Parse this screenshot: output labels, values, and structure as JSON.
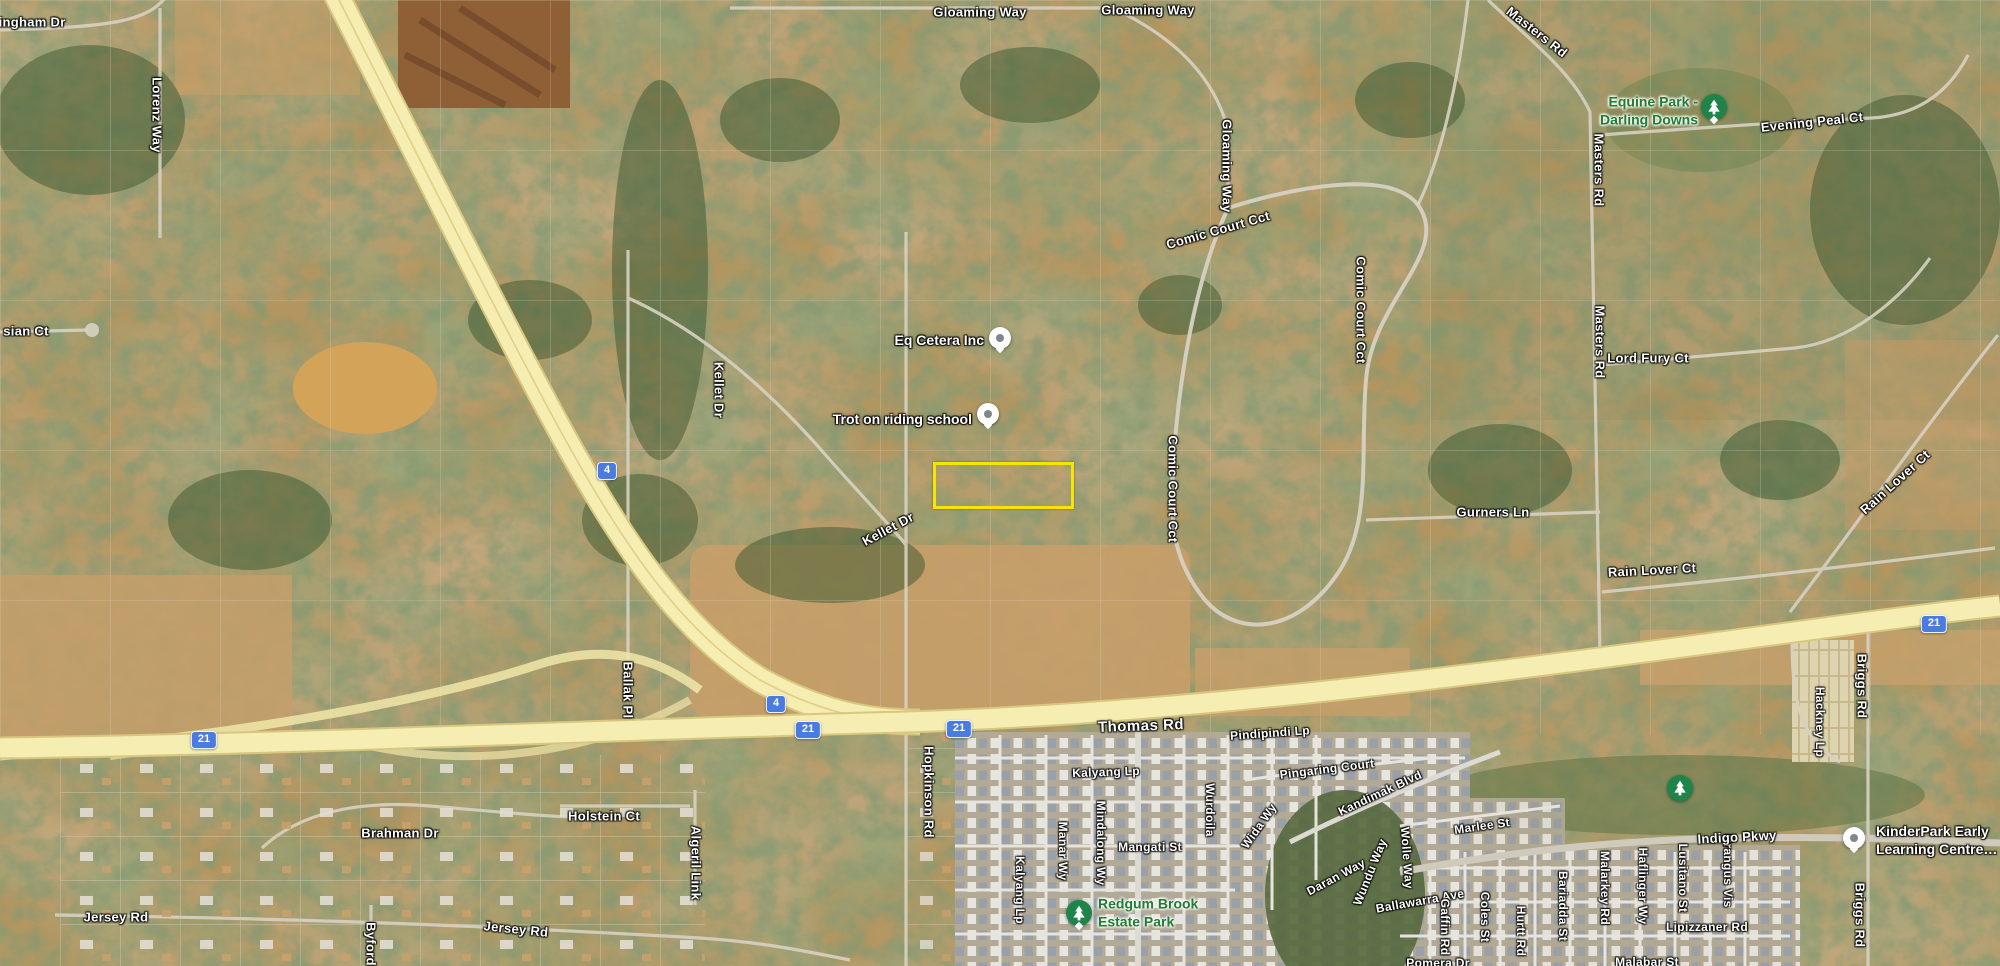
{
  "map": {
    "colors": {
      "highlight": "#f7e400",
      "freeway_yellow": "#f5edb2",
      "route_shield_blue": "#4a7ce0",
      "park_pin_green": "#1e8449",
      "park_text_green": "#217b31"
    },
    "highlight_parcel": {
      "x": 933,
      "y": 462,
      "w": 135,
      "h": 41
    },
    "road_labels": [
      {
        "text": "ningham Dr",
        "x": 28,
        "y": 22
      },
      {
        "text": "Lorenz Way",
        "x": 157,
        "y": 115,
        "rot": 90
      },
      {
        "text": "Gloaming Way",
        "x": 980,
        "y": 12
      },
      {
        "text": "Gloaming Way",
        "x": 1148,
        "y": 10
      },
      {
        "text": "Gloaming Way",
        "x": 1227,
        "y": 166,
        "rot": 90
      },
      {
        "text": "Masters Rd",
        "x": 1537,
        "y": 32,
        "rot": 38
      },
      {
        "text": "Evening Peal Ct",
        "x": 1812,
        "y": 122,
        "rot": -6
      },
      {
        "text": "Masters Rd",
        "x": 1599,
        "y": 170,
        "rot": 90
      },
      {
        "text": "Comic Court Cct",
        "x": 1218,
        "y": 230,
        "rot": -16
      },
      {
        "text": "Comic Court Cct",
        "x": 1361,
        "y": 310,
        "rot": 90
      },
      {
        "text": "Comic Court Cct",
        "x": 1173,
        "y": 489,
        "rot": 90
      },
      {
        "text": "Kellet Dr",
        "x": 719,
        "y": 390,
        "rot": 90
      },
      {
        "text": "Kellet Dr",
        "x": 888,
        "y": 529,
        "rot": -28
      },
      {
        "text": "Gurners Ln",
        "x": 1493,
        "y": 512
      },
      {
        "text": "Masters Rd",
        "x": 1600,
        "y": 342,
        "rot": 90
      },
      {
        "text": "Lord Fury Ct",
        "x": 1648,
        "y": 358
      },
      {
        "text": "Rain Lover Ct",
        "x": 1895,
        "y": 482,
        "rot": -42
      },
      {
        "text": "Rain Lover Ct",
        "x": 1652,
        "y": 570,
        "rot": -3
      },
      {
        "text": "Thomas Rd",
        "x": 1141,
        "y": 726,
        "rot": -2,
        "big": true
      },
      {
        "text": "Hopkinson Rd",
        "x": 929,
        "y": 792,
        "rot": 90
      },
      {
        "text": "Ballak Pl",
        "x": 628,
        "y": 690,
        "rot": 90
      },
      {
        "text": "Briggs Rd",
        "x": 1862,
        "y": 686,
        "rot": 90
      },
      {
        "text": "Hackney Lp",
        "x": 1820,
        "y": 722,
        "rot": 90,
        "small": true
      },
      {
        "text": "Pindipindi Lp",
        "x": 1270,
        "y": 733,
        "rot": -4,
        "small": true
      },
      {
        "text": "Pingaring Court",
        "x": 1327,
        "y": 769,
        "rot": -7,
        "small": true
      },
      {
        "text": "Kalyang Lp",
        "x": 1106,
        "y": 772,
        "rot": -2,
        "small": true
      },
      {
        "text": "Kalyang Lp",
        "x": 1020,
        "y": 890,
        "rot": 90,
        "small": true
      },
      {
        "text": "Manar Wy",
        "x": 1063,
        "y": 851,
        "rot": 90,
        "small": true
      },
      {
        "text": "Mindalong Wy",
        "x": 1101,
        "y": 843,
        "rot": 90,
        "small": true
      },
      {
        "text": "Mangati St",
        "x": 1150,
        "y": 847,
        "small": true
      },
      {
        "text": "Wurdoila",
        "x": 1210,
        "y": 810,
        "rot": 90,
        "small": true
      },
      {
        "text": "Wida Wy",
        "x": 1259,
        "y": 826,
        "rot": -55,
        "small": true
      },
      {
        "text": "Kandimak Blvd",
        "x": 1380,
        "y": 793,
        "rot": -25,
        "small": true
      },
      {
        "text": "Daran Way",
        "x": 1336,
        "y": 877,
        "rot": -28,
        "small": true
      },
      {
        "text": "Wundu Way",
        "x": 1370,
        "y": 872,
        "rot": -68,
        "small": true
      },
      {
        "text": "Ballawarra Ave",
        "x": 1420,
        "y": 901,
        "rot": -10,
        "small": true
      },
      {
        "text": "Marlee St",
        "x": 1482,
        "y": 826,
        "rot": -8,
        "small": true
      },
      {
        "text": "Wolle Way",
        "x": 1407,
        "y": 858,
        "rot": 86,
        "small": true
      },
      {
        "text": "Gaffin Rd",
        "x": 1445,
        "y": 927,
        "rot": 90,
        "small": true
      },
      {
        "text": "Coles St",
        "x": 1485,
        "y": 917,
        "rot": 90,
        "small": true
      },
      {
        "text": "Hurtt Rd",
        "x": 1521,
        "y": 931,
        "rot": 90,
        "small": true
      },
      {
        "text": "Bariadda St",
        "x": 1563,
        "y": 906,
        "rot": 90,
        "small": true
      },
      {
        "text": "Malarkey Rd",
        "x": 1605,
        "y": 888,
        "rot": 90,
        "small": true
      },
      {
        "text": "Haflinger Wy",
        "x": 1643,
        "y": 886,
        "rot": 90,
        "small": true
      },
      {
        "text": "Lusitano St",
        "x": 1683,
        "y": 878,
        "rot": 90,
        "small": true
      },
      {
        "text": "Brangus Vis",
        "x": 1728,
        "y": 871,
        "rot": 90,
        "small": true
      },
      {
        "text": "Lipizzaner Rd",
        "x": 1707,
        "y": 927,
        "small": true
      },
      {
        "text": "Malabar St",
        "x": 1647,
        "y": 962,
        "small": true
      },
      {
        "text": "Pomera Dr",
        "x": 1438,
        "y": 963,
        "small": true
      },
      {
        "text": "Indigo Pkwy",
        "x": 1737,
        "y": 837,
        "rot": -3
      },
      {
        "text": "Briggs Rd",
        "x": 1860,
        "y": 915,
        "rot": 90
      },
      {
        "text": "sian Ct",
        "x": 26,
        "y": 331
      },
      {
        "text": "Jersey Rd",
        "x": 116,
        "y": 917
      },
      {
        "text": "Jersey Rd",
        "x": 516,
        "y": 929,
        "rot": 6
      },
      {
        "text": "Byford",
        "x": 371,
        "y": 944,
        "rot": 90
      },
      {
        "text": "Brahman Dr",
        "x": 400,
        "y": 833
      },
      {
        "text": "Holstein Ct",
        "x": 604,
        "y": 816
      },
      {
        "text": "Algeril Link",
        "x": 696,
        "y": 863,
        "rot": 90
      }
    ],
    "route_shields": [
      {
        "number": "4",
        "x": 607,
        "y": 471
      },
      {
        "number": "4",
        "x": 776,
        "y": 704
      },
      {
        "number": "21",
        "x": 204,
        "y": 740
      },
      {
        "number": "21",
        "x": 808,
        "y": 730
      },
      {
        "number": "21",
        "x": 959,
        "y": 729
      },
      {
        "number": "21",
        "x": 1934,
        "y": 624
      }
    ],
    "pois": [
      {
        "name": "Eq Cetera Inc",
        "lines": [
          "Eq Cetera Inc"
        ],
        "pin_x": 1000,
        "pin_y": 338,
        "text_x": 984,
        "text_y": 340,
        "anchor": "right"
      },
      {
        "name": "Trot on riding school",
        "lines": [
          "Trot on riding school"
        ],
        "pin_x": 988,
        "pin_y": 414,
        "text_x": 972,
        "text_y": 419,
        "anchor": "right"
      },
      {
        "name": "KinderPark Early Learning Centre…",
        "lines": [
          "KinderPark Early",
          "Learning Centre…"
        ],
        "pin_x": 1854,
        "pin_y": 838,
        "text_x": 1876,
        "text_y": 840,
        "anchor": "left"
      }
    ],
    "parks": [
      {
        "name": "Equine Park - Darling Downs",
        "lines": [
          "Equine Park -",
          "Darling Downs"
        ],
        "icon": "pin-g",
        "icon_x": 1714,
        "icon_y": 107,
        "text_x": 1698,
        "text_y": 111,
        "anchor": "right"
      },
      {
        "name": "Redgum Brook Estate Park",
        "lines": [
          "Redgum Brook",
          "Estate Park"
        ],
        "icon": "pin-park",
        "icon_x": 1079,
        "icon_y": 913,
        "text_x": 1098,
        "text_y": 913,
        "anchor": "left"
      },
      {
        "name": "",
        "lines": [],
        "icon": "pin-drop",
        "icon_x": 1680,
        "icon_y": 788
      }
    ]
  }
}
